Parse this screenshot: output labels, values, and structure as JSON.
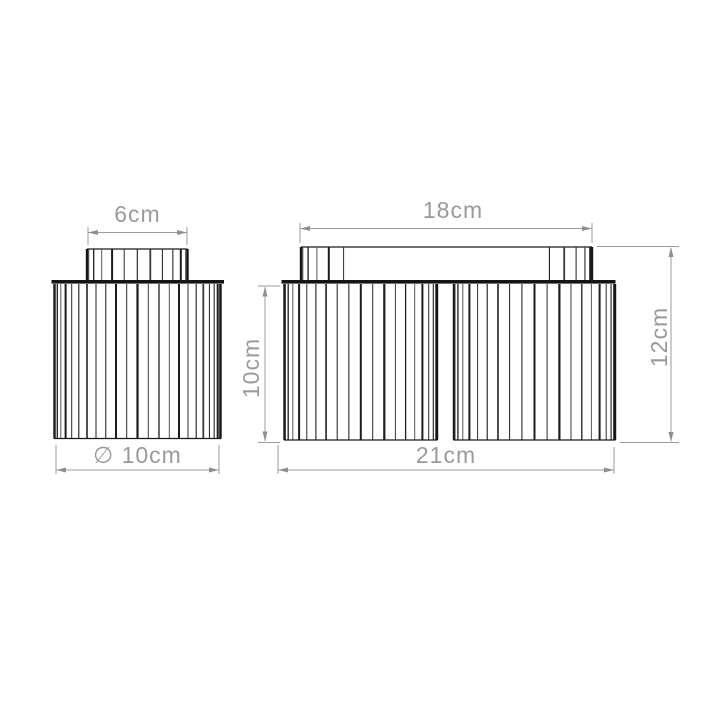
{
  "canvas": {
    "background": "#ffffff"
  },
  "drawing": {
    "title": "ribbed flush ceiling lights — dimension drawing",
    "style": {
      "outline_color": "#1a1a1a",
      "dimension_color": "#9b9b9b"
    },
    "left_fixture": {
      "name": "single flush light",
      "dims": {
        "cap_width": "6cm",
        "diameter": "∅ 10cm"
      }
    },
    "right_fixture": {
      "name": "twin flush light",
      "dims": {
        "canopy_width": "18cm",
        "shade_height": "10cm",
        "overall_height": "12cm",
        "overall_width": "21cm"
      }
    }
  }
}
